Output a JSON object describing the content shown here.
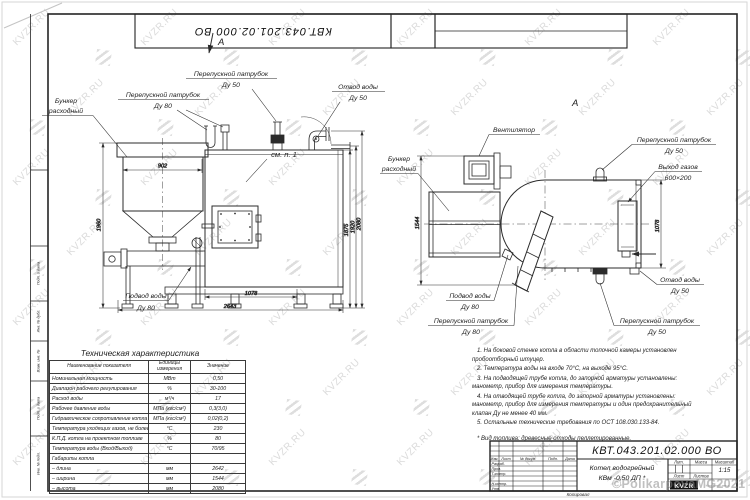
{
  "doc": {
    "number": "КВТ.043.201.02.000  ВО",
    "product_line1": "Котел водогрейный",
    "product_line2": "КВм -0,50  ДП *",
    "scale": "1:15",
    "kopiroval": "Копировал",
    "logo_text": "KVZR",
    "logo_caption": "Котельный завод",
    "view_marker": "А"
  },
  "title_block": {
    "cols": [
      "Изм.",
      "Лист",
      "№ докум.",
      "Подп.",
      "Дата"
    ],
    "roles": [
      "Разраб.",
      "Пров.",
      "Т.контр.",
      "Н.контр.",
      "Утв."
    ],
    "lit": "Лит.",
    "massa": "Масса",
    "masshtab": "Масштаб",
    "list": "Лист",
    "listov": "Листов"
  },
  "margin_labels": [
    "Подп. и дата",
    "Инв. № дубл.",
    "Взам. инв. №",
    "Подп. и дата",
    "Инв. № подл."
  ],
  "watermark": {
    "text": "KVZR.RU",
    "copyright": "©PolikarpovaMG2021"
  },
  "callouts": {
    "l_bunker1": "Бункер",
    "l_bunker2": "расходный",
    "l_pp80a": "Перепускной патрубок",
    "l_pp80b": "Ду 80",
    "l_pp50a": "Перепускной патрубок",
    "l_pp50b": "Ду 50",
    "l_otvoda": "Отвод воды",
    "l_otvodb": "Ду 50",
    "l_smp": "см. п. 1",
    "l_podvoda": "Подвод воды",
    "l_podvodb": "Ду 80",
    "r_fan": "Вентилятор",
    "r_bunker1": "Бункер",
    "r_bunker2": "расходный",
    "r_pp50ta": "Перепускной патрубок",
    "r_pp50tb": "Ду 50",
    "r_gasa": "Выход газов",
    "r_gasb": "600×200",
    "r_otvoda": "Отвод воды",
    "r_otvodb": "Ду 50",
    "r_pp50ba": "Перепускной патрубок",
    "r_pp50bb": "Ду 50",
    "r_pp80a": "Перепускной патрубок",
    "r_pp80b": "Ду 80",
    "r_podvoda": "Подвод воды",
    "r_podvodb": "Ду 80"
  },
  "dims": {
    "d902": "902",
    "d1960": "1960",
    "d1875": "1875",
    "d1920": "1920",
    "d2080": "2080",
    "d1078": "1078",
    "d2643": "2643",
    "d1544": "1544",
    "d1078r": "1078"
  },
  "table": {
    "title": "Техническая характеристика",
    "headers": [
      "Наименование показателя",
      "Единицы измерения",
      "Значение"
    ],
    "rows": [
      [
        "Номинальная мощность",
        "МВт",
        "0,50"
      ],
      [
        "Диапазон рабочего регулирования",
        "%",
        "30-100"
      ],
      [
        "Расход воды",
        "м³/ч",
        "17"
      ],
      [
        "Рабочее давление воды",
        "МПа (кгс/см²)",
        "0,3(3,0)"
      ],
      [
        "Гидравлическое сопротивление котла",
        "МПа (кгс/см²)",
        "0,02(0,2)"
      ],
      [
        "Температура уходящих газов, не более",
        "°С",
        "230"
      ],
      [
        "К.П.Д. котла на проектном топливе",
        "%",
        "80"
      ],
      [
        "Температура воды (Вход/Выход)",
        "°С",
        "70/95"
      ],
      [
        "Габариты котла",
        "",
        ""
      ],
      [
        "–  длина",
        "мм",
        "2642"
      ],
      [
        "–  ширина",
        "мм",
        "1544"
      ],
      [
        "–  высота",
        "мм",
        "2080"
      ]
    ]
  },
  "notes": {
    "items": [
      "1.  На боковой стенке котла в области топочной камеры установлен пробоотборный штуцер.",
      "2.  Температура воды на входе 70°С, на выходе 95°С.",
      "3.  На подводящей трубе котла, до запорной арматуры установлены: манометр, прибор для измерения температуры.",
      "4.  На отводящей трубе котла, до запорной арматуры установлены: манометр, прибор для измерения температуры и один предохранительный клапан Ду не менее 40 мм.",
      "5.  Остальные технические требования по ОСТ 108.030.133-84."
    ],
    "footnote": "*  Вид топлива:  древесные отходы пеллетированные."
  }
}
